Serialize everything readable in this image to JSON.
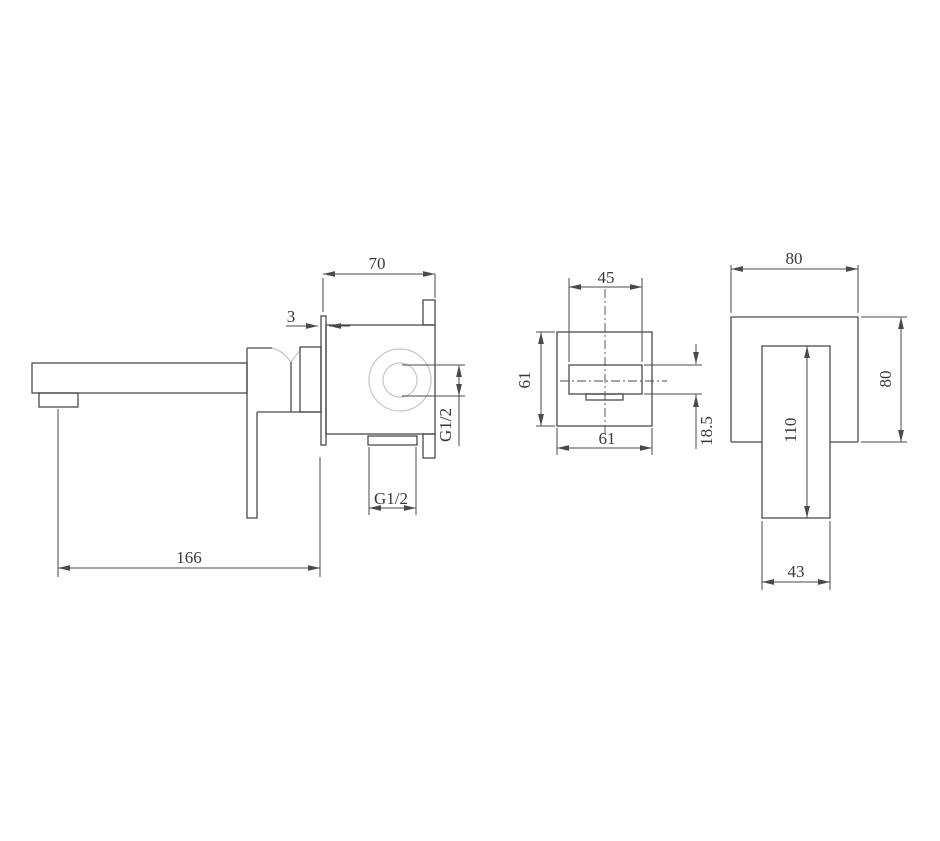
{
  "drawing": {
    "type": "technical-dimension-drawing",
    "subject": "wall-mounted basin mixer tap, three orthographic views",
    "colors": {
      "background": "#ffffff",
      "line": "#4a4a4a",
      "light_line": "#c5c5c5",
      "text": "#383838"
    }
  },
  "views": {
    "side": {
      "name": "side view (spout, handle, in-wall valve body)",
      "labels": {
        "projection": "70",
        "plate_thickness": "3",
        "inlet_thread": "G1/2",
        "outlet_thread": "G1/2",
        "overall_length": "166"
      }
    },
    "spout_plate": {
      "name": "spout wall-plate front view",
      "labels": {
        "spout_width": "45",
        "plate_height": "61",
        "plate_width": "61",
        "spout_height": "18.5"
      }
    },
    "handle_plate": {
      "name": "handle wall-plate front view",
      "labels": {
        "plate_width": "80",
        "plate_height": "80",
        "handle_length": "110",
        "handle_width": "43"
      }
    }
  }
}
